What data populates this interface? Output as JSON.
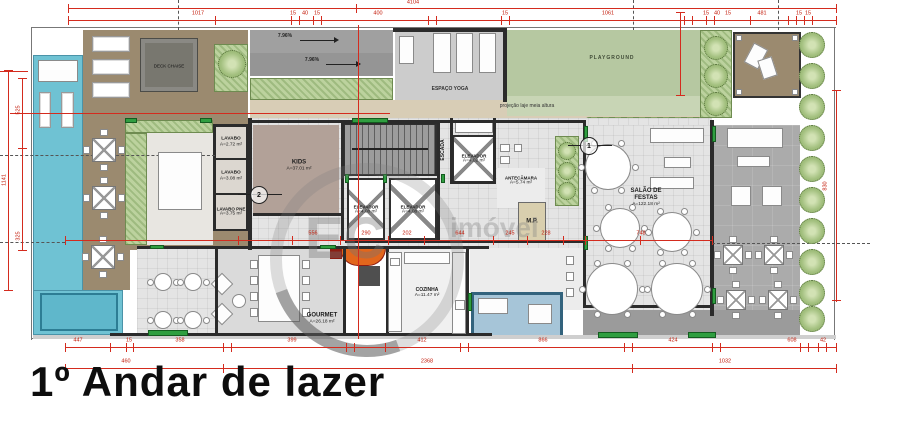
{
  "title": "1º Andar de lazer",
  "watermark": {
    "monogram": "EC",
    "text": "imóvel"
  },
  "annotations": {
    "deck_chaise": "DECK CHAISE",
    "espaco_yoga": "ESPAÇO YOGA",
    "playground": "PLAYGROUND",
    "projecao_laje": "projeção laje meia altura",
    "ramp_slope_upper": "7.96%",
    "ramp_slope_lower": "7.96%",
    "ref_circle_1": "1",
    "ref_circle_2": "2"
  },
  "rooms": {
    "kids": {
      "name": "KIDS",
      "area": "A=37.01 m²"
    },
    "lavabo_a": {
      "name": "LAVABO",
      "area": "A=2.72 m²"
    },
    "lavabo_b": {
      "name": "LAVABO",
      "area": "A=3.08 m²"
    },
    "lavabo_pne": {
      "name": "LAVABO PNE",
      "area": "A=3.75 m²"
    },
    "escada": {
      "name": "ESCADA"
    },
    "elevador_a": {
      "name": "ELEVADOR",
      "area": "A=4.08 m²"
    },
    "elevador_b": {
      "name": "ELEVADOR",
      "area": "A=4.08 m²"
    },
    "elevador_c": {
      "name": "ELEVADOR",
      "area": "A=4.02 m²"
    },
    "antecamara": {
      "name": "ANTECÂMARA",
      "area": "A=5.74 m²"
    },
    "mp": {
      "name": "M.P."
    },
    "salao": {
      "name": "SALÃO DE\nFESTAS",
      "area": "A=122.18 m²"
    },
    "gourmet": {
      "name": "GOURMET",
      "area": "A=26.18 m²"
    },
    "cozinha": {
      "name": "COZINHA",
      "area": "A=11.47 m²"
    }
  },
  "colors": {
    "dimension_red": "#c21807",
    "pool_blue": "#6fc2d3",
    "deck_brown": "#9b8a6f",
    "lawn_green": "#b6c8a1",
    "accent_green": "#2f9e40",
    "skylight_blue": "#a6c5d8"
  },
  "dimensions": {
    "labels": [
      {
        "t": "4104",
        "x": 413,
        "y": 3
      },
      {
        "t": "1017",
        "x": 198,
        "y": 14
      },
      {
        "t": "15",
        "x": 293,
        "y": 14
      },
      {
        "t": "40",
        "x": 305,
        "y": 14
      },
      {
        "t": "15",
        "x": 317,
        "y": 14
      },
      {
        "t": "400",
        "x": 378,
        "y": 14
      },
      {
        "t": "15",
        "x": 505,
        "y": 14
      },
      {
        "t": "1061",
        "x": 608,
        "y": 14
      },
      {
        "t": "15",
        "x": 706,
        "y": 14
      },
      {
        "t": "40",
        "x": 717,
        "y": 14
      },
      {
        "t": "15",
        "x": 728,
        "y": 14
      },
      {
        "t": "481",
        "x": 762,
        "y": 14
      },
      {
        "t": "15",
        "x": 799,
        "y": 14
      },
      {
        "t": "15",
        "x": 808,
        "y": 14
      },
      {
        "t": "556",
        "x": 313,
        "y": 234
      },
      {
        "t": "290",
        "x": 366,
        "y": 234
      },
      {
        "t": "202",
        "x": 407,
        "y": 234
      },
      {
        "t": "644",
        "x": 460,
        "y": 234
      },
      {
        "t": "245",
        "x": 510,
        "y": 234
      },
      {
        "t": "228",
        "x": 546,
        "y": 234
      },
      {
        "t": "748",
        "x": 641,
        "y": 234
      },
      {
        "t": "447",
        "x": 78,
        "y": 341
      },
      {
        "t": "15",
        "x": 129,
        "y": 341
      },
      {
        "t": "358",
        "x": 180,
        "y": 341
      },
      {
        "t": "399",
        "x": 292,
        "y": 341
      },
      {
        "t": "412",
        "x": 422,
        "y": 341
      },
      {
        "t": "866",
        "x": 543,
        "y": 341
      },
      {
        "t": "424",
        "x": 673,
        "y": 341
      },
      {
        "t": "608",
        "x": 792,
        "y": 341
      },
      {
        "t": "42",
        "x": 823,
        "y": 341
      },
      {
        "t": "460",
        "x": 126,
        "y": 362
      },
      {
        "t": "2368",
        "x": 427,
        "y": 362
      },
      {
        "t": "1032",
        "x": 725,
        "y": 362
      },
      {
        "t": "1141",
        "x": 5,
        "y": 180,
        "rot": 1
      },
      {
        "t": "525",
        "x": 19,
        "y": 110,
        "rot": 1
      },
      {
        "t": "325",
        "x": 19,
        "y": 236,
        "rot": 1
      },
      {
        "t": "830",
        "x": 826,
        "y": 186,
        "rot": 1
      }
    ]
  }
}
